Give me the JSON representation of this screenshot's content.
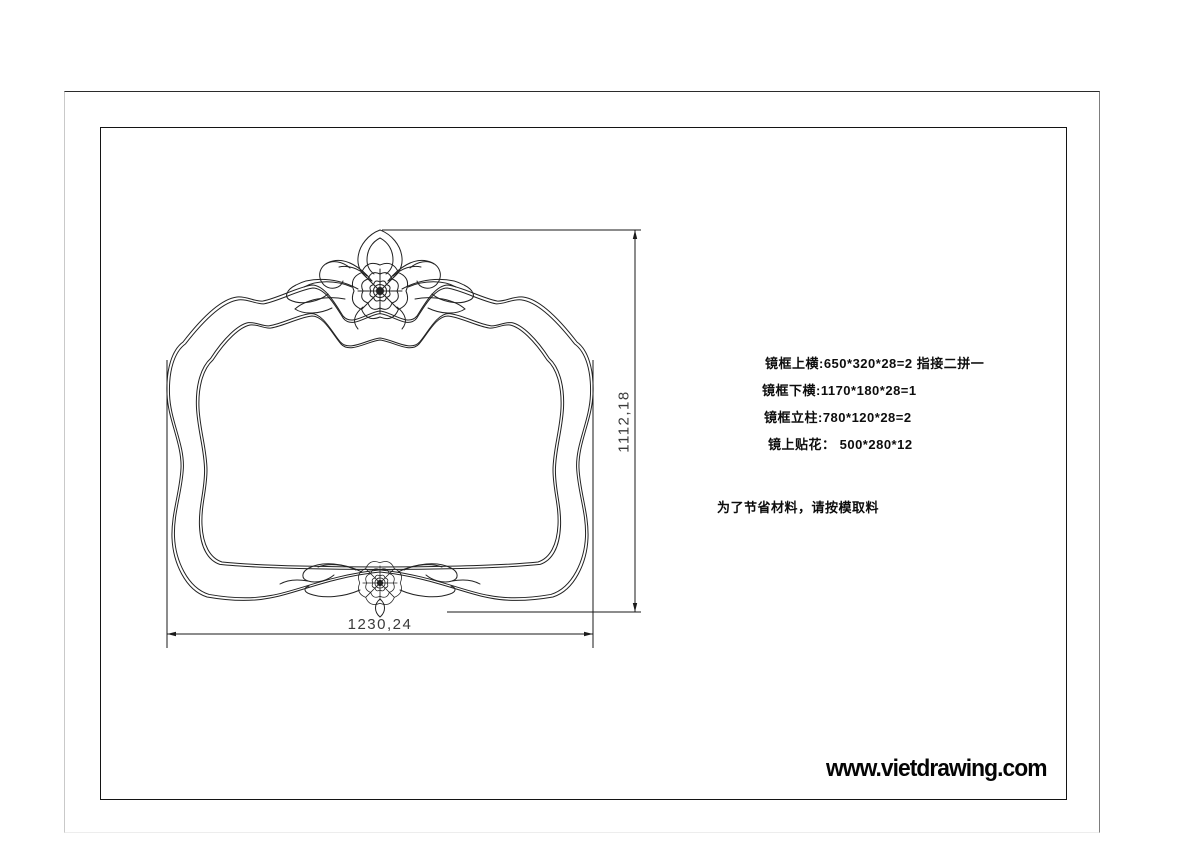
{
  "drawing": {
    "dim_height_label": "1112,18",
    "dim_width_label": "1230,24",
    "cut_list": [
      "镜框上横:650*320*28=2  指接二拼一",
      "镜框下横:1170*180*28=1",
      "镜框立柱:780*120*28=2",
      "镜上贴花： 500*280*12"
    ],
    "material_note": "为了节省材料，请按模取料",
    "watermark": "www.vietdrawing.com",
    "colors": {
      "line": "#222222",
      "sheet_border": "#141414",
      "page_edge": "#7d7d7d"
    }
  }
}
